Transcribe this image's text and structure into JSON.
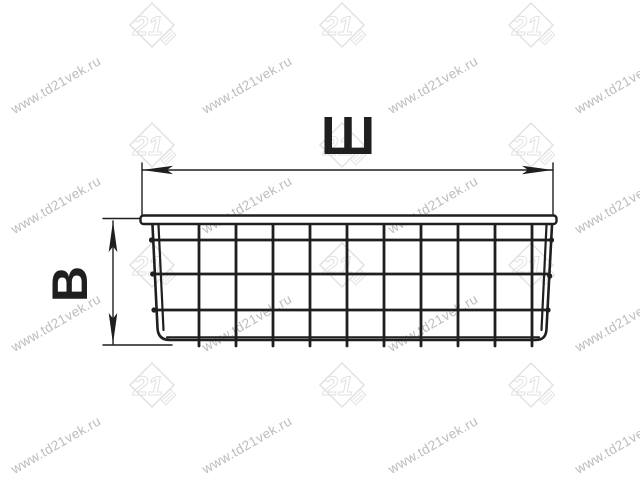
{
  "diagram": {
    "width_label": "Ш",
    "height_label": "В"
  },
  "watermark": {
    "text": "www.td21vek.ru",
    "logo_text": "21"
  },
  "colors": {
    "background": "#ffffff",
    "line": "#1f1f1f",
    "watermark_text": "#bcbcbc",
    "watermark_logo": "#e2e2e2"
  }
}
